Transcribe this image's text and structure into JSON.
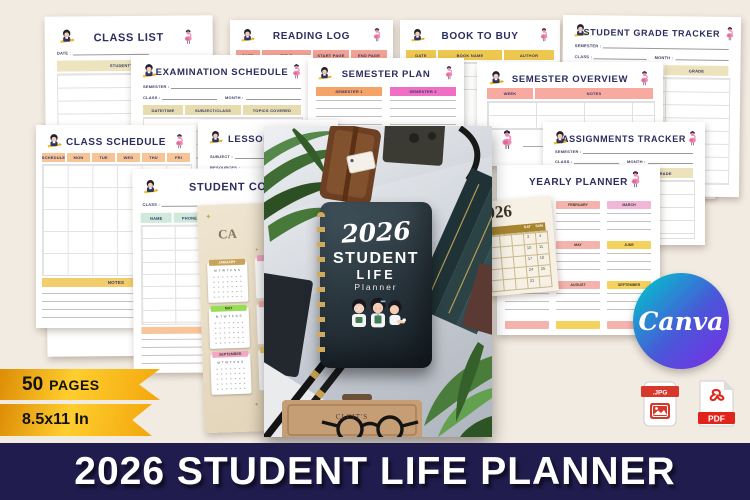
{
  "banner": {
    "title": "2026 STUDENT LIFE PLANNER"
  },
  "badges": {
    "pages_number": "50",
    "pages_word": "PAGES",
    "size": "8.5x11 In"
  },
  "logos": {
    "canva": "Canva",
    "jpg": ".JPG",
    "pdf": "PDF"
  },
  "cover": {
    "year": "2026",
    "title_top": "STUDENT",
    "title_mid": "LIFE",
    "title_sub": "Planner",
    "box_label": "CLCIT'S"
  },
  "pages": {
    "class_list": {
      "title": "CLASS LIST",
      "date_label": "DATE :",
      "col_student": "STUDENT'S NAME"
    },
    "reading_log": {
      "title": "READING LOG",
      "cols": [
        "DATE",
        "TITLE",
        "START PAGE",
        "END PAGE"
      ]
    },
    "book_to_buy": {
      "title": "BOOK TO BUY",
      "cols": [
        "DATE",
        "BOOK NAME",
        "AUTHOR"
      ]
    },
    "grade_tracker": {
      "title": "STUDENT GRADE TRACKER",
      "semester_label": "SEMESTER :",
      "class_label": "CLASS :",
      "month_label": "MONTH :",
      "cols": [
        "ASSIGNMENT/ QUIZ",
        "GRADE"
      ]
    },
    "exam_schedule": {
      "title": "EXAMINATION SCHEDULE",
      "semester_label": "SEMESTER :",
      "class_label": "CLASS :",
      "month_label": "MONTH :",
      "cols": [
        "DATE/TIME",
        "SUBJECT/CLASS",
        "TOPICS COVERED"
      ]
    },
    "semester_plan": {
      "title": "SEMESTER PLAN",
      "cols": [
        "SEMESTER 1",
        "SEMESTER 2"
      ]
    },
    "semester_overview": {
      "title": "SEMESTER OVERVIEW",
      "cols": [
        "WEEK",
        "NOTES"
      ]
    },
    "class_schedule": {
      "title": "CLASS SCHEDULE",
      "cols": [
        "SCHEDULE",
        "MON",
        "TUE",
        "WED",
        "THU",
        "FRI"
      ],
      "notes_label": "NOTES"
    },
    "lesson_plan": {
      "title": "LESSON PLAN",
      "subject_label": "SUBJECT :",
      "resources_label": "RESOURCES :"
    },
    "assignments_tracker": {
      "title": "ASSIGNMENTS TRACKER",
      "semester_label": "SEMESTER :",
      "class_label": "CLASS :",
      "month_label": "MONTH :",
      "cols": [
        "ASSIGNMENT/ QUIZ",
        "GRADE"
      ]
    },
    "contact_list": {
      "title": "STUDENT CONTACT LIST",
      "class_label": "CLASS :",
      "cols": [
        "NAME",
        "PHONE",
        "EMAIL",
        "BIRTHDAY"
      ]
    },
    "yearly_planner": {
      "title": "YEARLY PLANNER",
      "row1": [
        "JANUARY",
        "FEBRUARY",
        "MARCH"
      ],
      "row2": [
        "",
        "MAY",
        "JUNE"
      ],
      "row3": [
        "",
        "AUGUST",
        "SEPTEMBER"
      ]
    },
    "month_page": {
      "year": "2026",
      "sat": "SAT",
      "sun": "SUN",
      "sat_dates": [
        "3",
        "10",
        "17",
        "24",
        "31"
      ],
      "sun_dates": [
        "4",
        "11",
        "18",
        "25"
      ]
    },
    "mini_calendar": {
      "watermark": "CA",
      "weekdays": "M T W T F S S",
      "months": [
        "JANUARY",
        "MAY",
        "SEPTEMBER"
      ]
    }
  }
}
